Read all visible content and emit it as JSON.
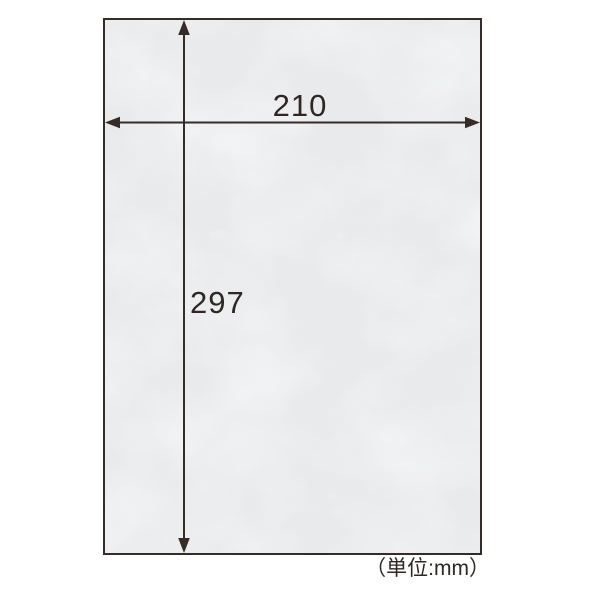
{
  "diagram": {
    "width_label": "210",
    "height_label": "297",
    "unit_note": "（単位:mm）",
    "paper": {
      "type": "textured-washi-sheet",
      "width_mm": 210,
      "height_mm": 297
    },
    "colors": {
      "background": "#ffffff",
      "paper_fill": "#e9eaec",
      "paper_fiber_highlight": "#ffffff",
      "line_and_border": "#362c27",
      "text": "#2e2723"
    }
  }
}
